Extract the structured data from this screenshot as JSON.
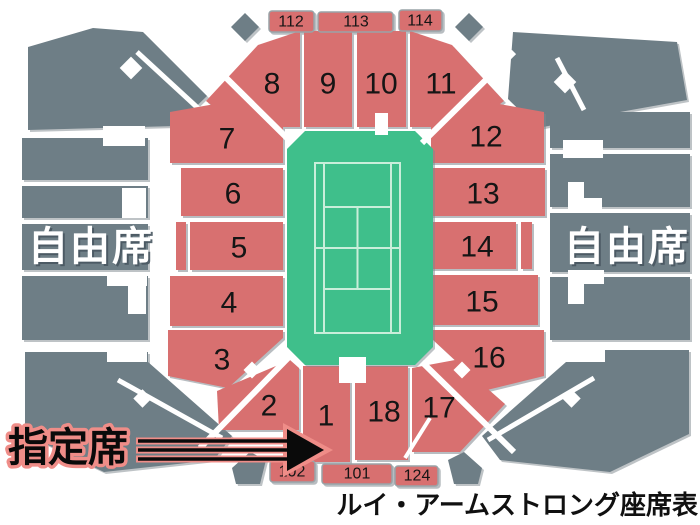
{
  "title": "ルイ・アームストロング座席表",
  "legend": {
    "free_seat_left": "自由席",
    "free_seat_right": "自由席",
    "reserved_seat": "指定席"
  },
  "sections": [
    "1",
    "2",
    "3",
    "4",
    "5",
    "6",
    "7",
    "8",
    "9",
    "10",
    "11",
    "12",
    "13",
    "14",
    "15",
    "16",
    "17",
    "18"
  ],
  "gate_tabs": {
    "top": [
      "112",
      "113",
      "114"
    ],
    "bottom": [
      "102",
      "101",
      "124"
    ]
  },
  "colors": {
    "reserved_section": "#d87070",
    "free_stand": "#6e7e86",
    "court_green": "#3fbf8b",
    "court_line": "#c9eeda",
    "reserved_label_outline": "#ef8d88"
  }
}
